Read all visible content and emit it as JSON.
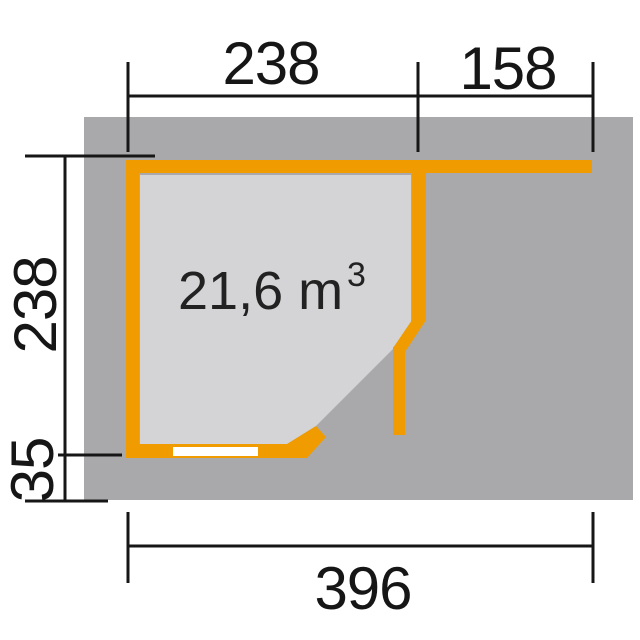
{
  "floor_plan": {
    "description": "Garden house floor plan with pentagonal corner room, open door leaf and side annex roof",
    "volume_label": {
      "value": "21,6 m",
      "superscript": "3",
      "full_text": "21,6 m³"
    },
    "dimensions": {
      "top_room_width": "238",
      "top_annex_width": "158",
      "side_depth": "238",
      "side_overhang": "35",
      "total_width": "396"
    },
    "colors": {
      "wall_orange": "#F09C00",
      "roof_gray": "#A9A9AB",
      "interior_gray": "#D4D4D6",
      "dimension_black": "#161616",
      "door_white": "#FFFFFF",
      "background": "#FFFFFF"
    }
  }
}
